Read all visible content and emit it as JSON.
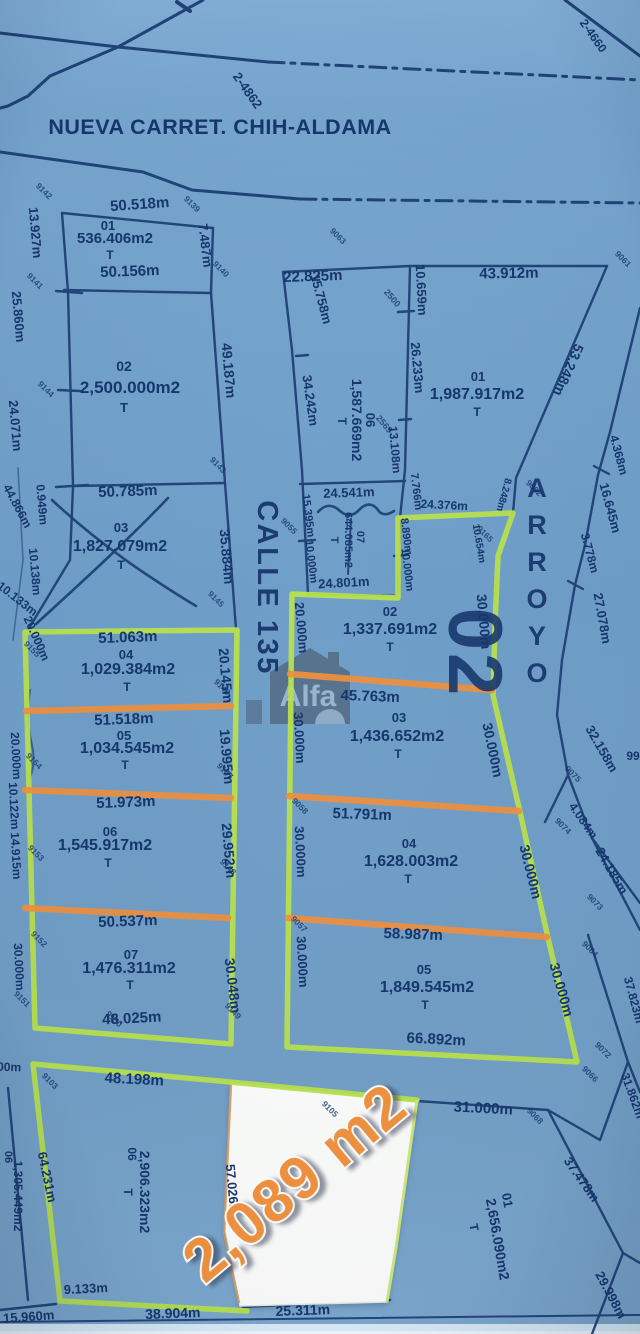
{
  "page": {
    "road_title": "NUEVA CARRET. CHIH-ALDAMA",
    "street_label": "CALLE 135",
    "block_number": "02",
    "watermark": "Alfa",
    "highlight_area": "2,089 m2"
  },
  "colors": {
    "paper_blue": "#74a3cc",
    "line_navy": "#1c3e74",
    "text_navy": "#17366d",
    "boundary_green": "#b9e14e",
    "divider_orange": "#ef9040",
    "highlight_orange": "#f2923e",
    "parcel_white": "#fcfdfb"
  },
  "labels": [
    {
      "t": "2-4862",
      "x": 244,
      "y": 93,
      "r": 55,
      "s": 13
    },
    {
      "t": "2-4660",
      "x": 590,
      "y": 38,
      "r": 55,
      "s": 12
    },
    {
      "t": "50.518m",
      "x": 140,
      "y": 209,
      "r": -4,
      "s": 15
    },
    {
      "t": "01",
      "x": 108,
      "y": 230,
      "s": 13,
      "k": "id"
    },
    {
      "t": "536.406m2",
      "x": 115,
      "y": 243,
      "s": 15,
      "k": "a"
    },
    {
      "t": "T",
      "x": 110,
      "y": 259,
      "s": 12,
      "k": "tee"
    },
    {
      "t": "50.156m",
      "x": 130,
      "y": 276,
      "r": -2,
      "s": 15
    },
    {
      "t": "7.487m",
      "x": 201,
      "y": 246,
      "r": 83,
      "s": 13
    },
    {
      "t": "13.927m",
      "x": 31,
      "y": 233,
      "r": 85,
      "s": 13
    },
    {
      "t": "02",
      "x": 124,
      "y": 371,
      "s": 14,
      "k": "id"
    },
    {
      "t": "2,500.000m2",
      "x": 130,
      "y": 393,
      "s": 17,
      "k": "a"
    },
    {
      "t": "T",
      "x": 124,
      "y": 412,
      "s": 13,
      "k": "tee"
    },
    {
      "t": "49.187m",
      "x": 224,
      "y": 371,
      "r": 85,
      "s": 14
    },
    {
      "t": "25.860m",
      "x": 14,
      "y": 317,
      "r": 85,
      "s": 13
    },
    {
      "t": "24.071m",
      "x": 11,
      "y": 426,
      "r": 85,
      "s": 13
    },
    {
      "t": "50.785m",
      "x": 128,
      "y": 496,
      "r": -2,
      "s": 15
    },
    {
      "t": "03",
      "x": 121,
      "y": 532,
      "s": 13,
      "k": "id"
    },
    {
      "t": "1,827.079m2",
      "x": 120,
      "y": 551,
      "s": 16,
      "k": "a"
    },
    {
      "t": "T",
      "x": 121,
      "y": 569,
      "s": 12,
      "k": "tee"
    },
    {
      "t": "35.884m",
      "x": 222,
      "y": 557,
      "r": 85,
      "s": 14
    },
    {
      "t": "0.949m",
      "x": 38,
      "y": 505,
      "r": 85,
      "s": 12
    },
    {
      "t": "44.866m",
      "x": 14,
      "y": 508,
      "r": 62,
      "s": 12
    },
    {
      "t": "10.138m",
      "x": 31,
      "y": 572,
      "r": 85,
      "s": 12
    },
    {
      "t": "10.133m",
      "x": 15,
      "y": 602,
      "r": 38,
      "s": 12
    },
    {
      "t": "20.000m",
      "x": 33,
      "y": 640,
      "r": 66,
      "s": 12
    },
    {
      "t": "51.063m",
      "x": 128,
      "y": 642,
      "r": -2,
      "s": 15
    },
    {
      "t": "04",
      "x": 126,
      "y": 659,
      "s": 13,
      "k": "id"
    },
    {
      "t": "1,029.384m2",
      "x": 128,
      "y": 674,
      "s": 16,
      "k": "a"
    },
    {
      "t": "T",
      "x": 127,
      "y": 691,
      "s": 12,
      "k": "tee"
    },
    {
      "t": "20.145m",
      "x": 221,
      "y": 676,
      "r": 85,
      "s": 14
    },
    {
      "t": "51.518m",
      "x": 124,
      "y": 724,
      "r": -2,
      "s": 15
    },
    {
      "t": "05",
      "x": 124,
      "y": 740,
      "s": 13,
      "k": "id"
    },
    {
      "t": "1,034.545m2",
      "x": 127,
      "y": 753,
      "s": 16,
      "k": "a"
    },
    {
      "t": "T",
      "x": 125,
      "y": 769,
      "s": 12,
      "k": "tee"
    },
    {
      "t": "19.995m",
      "x": 222,
      "y": 757,
      "r": 85,
      "s": 14
    },
    {
      "t": "20.000m",
      "x": 12,
      "y": 756,
      "r": 87,
      "s": 12
    },
    {
      "t": "51.973m",
      "x": 126,
      "y": 807,
      "r": -2,
      "s": 15
    },
    {
      "t": "06",
      "x": 110,
      "y": 836,
      "s": 13,
      "k": "id"
    },
    {
      "t": "1,545.917m2",
      "x": 105,
      "y": 850,
      "s": 16,
      "k": "a"
    },
    {
      "t": "T",
      "x": 108,
      "y": 867,
      "s": 12,
      "k": "tee"
    },
    {
      "t": "29.952m",
      "x": 224,
      "y": 851,
      "r": 85,
      "s": 14
    },
    {
      "t": "10.122m",
      "x": 10,
      "y": 806,
      "r": 87,
      "s": 12
    },
    {
      "t": "14.915m",
      "x": 12,
      "y": 856,
      "r": 87,
      "s": 12
    },
    {
      "t": "50.537m",
      "x": 128,
      "y": 926,
      "r": -2,
      "s": 15
    },
    {
      "t": "07",
      "x": 131,
      "y": 959,
      "s": 13,
      "k": "id"
    },
    {
      "t": "1,476.311m2",
      "x": 129,
      "y": 973,
      "s": 16,
      "k": "a"
    },
    {
      "t": "T",
      "x": 130,
      "y": 989,
      "s": 12,
      "k": "tee"
    },
    {
      "t": "30.048m",
      "x": 228,
      "y": 986,
      "r": 83,
      "s": 14
    },
    {
      "t": "30.000m",
      "x": 15,
      "y": 967,
      "r": 87,
      "s": 12
    },
    {
      "t": "48.025m",
      "x": 132,
      "y": 1023,
      "r": -3,
      "s": 15
    },
    {
      "t": "22.825m",
      "x": 313,
      "y": 281,
      "r": -2,
      "s": 15
    },
    {
      "t": "10.659m",
      "x": 417,
      "y": 290,
      "r": 87,
      "s": 13
    },
    {
      "t": "43.912m",
      "x": 509,
      "y": 278,
      "r": -1,
      "s": 15
    },
    {
      "t": "15.758m",
      "x": 317,
      "y": 300,
      "r": 75,
      "s": 13
    },
    {
      "t": "34.242m",
      "x": 306,
      "y": 401,
      "r": 82,
      "s": 13
    },
    {
      "t": "26.233m",
      "x": 413,
      "y": 368,
      "r": 85,
      "s": 13
    },
    {
      "t": "13.108m",
      "x": 391,
      "y": 450,
      "r": 85,
      "s": 12
    },
    {
      "t": "06",
      "x": 366,
      "y": 420,
      "r": 90,
      "s": 13,
      "k": "id"
    },
    {
      "t": "1,587.669m2",
      "x": 352,
      "y": 420,
      "r": 90,
      "s": 14,
      "k": "a"
    },
    {
      "t": "T",
      "x": 338,
      "y": 421,
      "r": 90,
      "s": 12,
      "k": "tee"
    },
    {
      "t": "01",
      "x": 478,
      "y": 381,
      "s": 13,
      "k": "id"
    },
    {
      "t": "1,987.917m2",
      "x": 477,
      "y": 399,
      "s": 16,
      "k": "a"
    },
    {
      "t": "T",
      "x": 477,
      "y": 416,
      "s": 12,
      "k": "tee"
    },
    {
      "t": "53.248m",
      "x": 564,
      "y": 368,
      "r": 114,
      "s": 14
    },
    {
      "t": "8.248m",
      "x": 501,
      "y": 494,
      "r": 105,
      "s": 10
    },
    {
      "t": "24.541m",
      "x": 349,
      "y": 497,
      "r": -2,
      "s": 13
    },
    {
      "t": "07",
      "x": 357,
      "y": 537,
      "r": 90,
      "s": 11,
      "k": "id"
    },
    {
      "t": "644.085m2",
      "x": 345,
      "y": 540,
      "r": 90,
      "s": 11,
      "k": "a"
    },
    {
      "t": "T",
      "x": 331,
      "y": 540,
      "r": 90,
      "s": 11,
      "k": "tee"
    },
    {
      "t": "24.801m",
      "x": 344,
      "y": 587,
      "r": -3,
      "s": 13
    },
    {
      "t": "15.395m",
      "x": 305,
      "y": 516,
      "r": 83,
      "s": 11
    },
    {
      "t": "10.000m",
      "x": 308,
      "y": 562,
      "r": 83,
      "s": 11
    },
    {
      "t": "7.766m",
      "x": 413,
      "y": 492,
      "r": 83,
      "s": 11
    },
    {
      "t": "8.890m",
      "x": 403,
      "y": 537,
      "r": 83,
      "s": 11
    },
    {
      "t": "10.000m",
      "x": 404,
      "y": 570,
      "r": 83,
      "s": 11
    },
    {
      "t": "24.376m",
      "x": 444,
      "y": 509,
      "r": 3,
      "s": 12
    },
    {
      "t": "10.654m",
      "x": 476,
      "y": 544,
      "r": 80,
      "s": 10
    },
    {
      "t": "02",
      "x": 390,
      "y": 616,
      "s": 13,
      "k": "id"
    },
    {
      "t": "1,337.691m2",
      "x": 390,
      "y": 634,
      "s": 16,
      "k": "a"
    },
    {
      "t": "T",
      "x": 390,
      "y": 651,
      "s": 12,
      "k": "tee"
    },
    {
      "t": "20.000m",
      "x": 297,
      "y": 628,
      "r": 85,
      "s": 13
    },
    {
      "t": "30.000m",
      "x": 479,
      "y": 622,
      "r": 85,
      "s": 14
    },
    {
      "t": "45.763m",
      "x": 370,
      "y": 701,
      "r": 2,
      "s": 15
    },
    {
      "t": "03",
      "x": 399,
      "y": 722,
      "s": 13,
      "k": "id"
    },
    {
      "t": "1,436.652m2",
      "x": 397,
      "y": 741,
      "s": 16,
      "k": "a"
    },
    {
      "t": "T",
      "x": 398,
      "y": 758,
      "s": 12,
      "k": "tee"
    },
    {
      "t": "30.000m",
      "x": 295,
      "y": 738,
      "r": 87,
      "s": 13
    },
    {
      "t": "30.000m",
      "x": 488,
      "y": 751,
      "r": 78,
      "s": 14
    },
    {
      "t": "51.791m",
      "x": 362,
      "y": 819,
      "r": 2,
      "s": 15
    },
    {
      "t": "04",
      "x": 409,
      "y": 848,
      "s": 13,
      "k": "id"
    },
    {
      "t": "1,628.003m2",
      "x": 411,
      "y": 866,
      "s": 16,
      "k": "a"
    },
    {
      "t": "T",
      "x": 408,
      "y": 883,
      "s": 12,
      "k": "tee"
    },
    {
      "t": "30.000m",
      "x": 296,
      "y": 852,
      "r": 87,
      "s": 13
    },
    {
      "t": "30.000m",
      "x": 526,
      "y": 873,
      "r": 76,
      "s": 14
    },
    {
      "t": "58.987m",
      "x": 413,
      "y": 939,
      "r": 2,
      "s": 15
    },
    {
      "t": "05",
      "x": 424,
      "y": 974,
      "s": 13,
      "k": "id"
    },
    {
      "t": "1,849.545m2",
      "x": 427,
      "y": 992,
      "s": 16,
      "k": "a"
    },
    {
      "t": "T",
      "x": 425,
      "y": 1009,
      "s": 12,
      "k": "tee"
    },
    {
      "t": "30.000m",
      "x": 298,
      "y": 962,
      "r": 87,
      "s": 13
    },
    {
      "t": "30.000m",
      "x": 557,
      "y": 991,
      "r": 74,
      "s": 14
    },
    {
      "t": "66.892m",
      "x": 436,
      "y": 1044,
      "r": 3,
      "s": 15
    },
    {
      "t": "ARROYO",
      "x": 537,
      "y": 497,
      "s": 27,
      "k": "vs",
      "dy": 37
    },
    {
      "t": "4.368m",
      "x": 615,
      "y": 456,
      "r": 75,
      "s": 12
    },
    {
      "t": "16.645m",
      "x": 606,
      "y": 509,
      "r": 75,
      "s": 13
    },
    {
      "t": "3.778m",
      "x": 586,
      "y": 554,
      "r": 75,
      "s": 12
    },
    {
      "t": "27.078m",
      "x": 598,
      "y": 619,
      "r": 80,
      "s": 13
    },
    {
      "t": "32.158m",
      "x": 598,
      "y": 751,
      "r": 60,
      "s": 13
    },
    {
      "t": "99",
      "x": 633,
      "y": 760,
      "r": 0,
      "s": 12
    },
    {
      "t": "4.084m",
      "x": 580,
      "y": 823,
      "r": 55,
      "s": 12
    },
    {
      "t": "24.185m",
      "x": 608,
      "y": 873,
      "r": 60,
      "s": 13
    },
    {
      "t": "37.823m",
      "x": 630,
      "y": 1001,
      "r": 75,
      "s": 12
    },
    {
      "t": "31.862m",
      "x": 629,
      "y": 1097,
      "r": 70,
      "s": 12
    },
    {
      "t": "48.198m",
      "x": 134,
      "y": 1084,
      "r": 3,
      "s": 15
    },
    {
      "t": "06",
      "x": 128,
      "y": 1154,
      "r": 90,
      "s": 12,
      "k": "id"
    },
    {
      "t": "2,906.323m2",
      "x": 140,
      "y": 1192,
      "r": 90,
      "s": 14,
      "k": "a"
    },
    {
      "t": "T",
      "x": 124,
      "y": 1192,
      "r": 90,
      "s": 12,
      "k": "tee"
    },
    {
      "t": "64.231m",
      "x": 43,
      "y": 1178,
      "r": 78,
      "s": 13
    },
    {
      "t": "57.026m",
      "x": 228,
      "y": 1190,
      "r": 85,
      "s": 13
    },
    {
      "t": "06",
      "x": 5,
      "y": 1157,
      "r": 90,
      "s": 11,
      "k": "id"
    },
    {
      "t": "1,305.449m2",
      "x": 14,
      "y": 1196,
      "r": 90,
      "s": 12,
      "k": "a"
    },
    {
      "t": "9.133m",
      "x": 86,
      "y": 1293,
      "r": -3,
      "s": 13
    },
    {
      "t": "15.960m",
      "x": 29,
      "y": 1321,
      "r": -4,
      "s": 13
    },
    {
      "t": "38.904m",
      "x": 173,
      "y": 1318,
      "r": -2,
      "s": 14
    },
    {
      "t": "25.311m",
      "x": 303,
      "y": 1315,
      "r": -2,
      "s": 14
    },
    {
      "t": "00m",
      "x": 9,
      "y": 1071,
      "r": 2,
      "s": 12
    },
    {
      "t": "31.000m",
      "x": 483,
      "y": 1113,
      "r": 3,
      "s": 15
    },
    {
      "t": "37.478m",
      "x": 578,
      "y": 1182,
      "r": 55,
      "s": 13
    },
    {
      "t": "01",
      "x": 503,
      "y": 1201,
      "r": 80,
      "s": 13,
      "k": "id"
    },
    {
      "t": "2,656.090m2",
      "x": 493,
      "y": 1240,
      "r": 80,
      "s": 14,
      "k": "a"
    },
    {
      "t": "T",
      "x": 470,
      "y": 1228,
      "r": 80,
      "s": 12,
      "k": "tee"
    },
    {
      "t": "29.998m",
      "x": 607,
      "y": 1297,
      "r": 62,
      "s": 13
    },
    {
      "t": "9142",
      "x": 42,
      "y": 193,
      "k": "pt"
    },
    {
      "t": "9139",
      "x": 190,
      "y": 206,
      "k": "pt"
    },
    {
      "t": "9141",
      "x": 33,
      "y": 283,
      "k": "pt"
    },
    {
      "t": "9140",
      "x": 219,
      "y": 271,
      "k": "pt"
    },
    {
      "t": "9144",
      "x": 44,
      "y": 391,
      "k": "pt"
    },
    {
      "t": "9143",
      "x": 216,
      "y": 467,
      "k": "pt"
    },
    {
      "t": "9063",
      "x": 336,
      "y": 238,
      "k": "pt"
    },
    {
      "t": "9061",
      "x": 621,
      "y": 261,
      "k": "pt"
    },
    {
      "t": "9062",
      "x": 532,
      "y": 490,
      "k": "pt"
    },
    {
      "t": "9055",
      "x": 287,
      "y": 528,
      "k": "pt"
    },
    {
      "t": "9165",
      "x": 483,
      "y": 536,
      "k": "pt"
    },
    {
      "t": "9145",
      "x": 214,
      "y": 601,
      "k": "pt"
    },
    {
      "t": "9146",
      "x": 220,
      "y": 689,
      "k": "pt"
    },
    {
      "t": "9147",
      "x": 223,
      "y": 773,
      "k": "pt"
    },
    {
      "t": "9148",
      "x": 226,
      "y": 869,
      "k": "pt"
    },
    {
      "t": "9149",
      "x": 231,
      "y": 1013,
      "k": "pt"
    },
    {
      "t": "9151",
      "x": 20,
      "y": 1001,
      "k": "pt"
    },
    {
      "t": "9150",
      "x": 112,
      "y": 1021,
      "k": "pt"
    },
    {
      "t": "9155",
      "x": 30,
      "y": 651,
      "k": "pt"
    },
    {
      "t": "9154",
      "x": 32,
      "y": 763,
      "k": "pt"
    },
    {
      "t": "9153",
      "x": 34,
      "y": 855,
      "k": "pt"
    },
    {
      "t": "9152",
      "x": 37,
      "y": 941,
      "k": "pt"
    },
    {
      "t": "9058",
      "x": 298,
      "y": 808,
      "k": "pt"
    },
    {
      "t": "9057",
      "x": 297,
      "y": 926,
      "k": "pt"
    },
    {
      "t": "9075",
      "x": 571,
      "y": 776,
      "k": "pt"
    },
    {
      "t": "9074",
      "x": 561,
      "y": 828,
      "k": "pt"
    },
    {
      "t": "9073",
      "x": 593,
      "y": 904,
      "k": "pt"
    },
    {
      "t": "9064",
      "x": 588,
      "y": 951,
      "k": "pt"
    },
    {
      "t": "9072",
      "x": 601,
      "y": 1052,
      "k": "pt"
    },
    {
      "t": "9066",
      "x": 588,
      "y": 1076,
      "k": "pt"
    },
    {
      "t": "9068",
      "x": 533,
      "y": 1118,
      "k": "pt"
    },
    {
      "t": "9103",
      "x": 48,
      "y": 1083,
      "k": "pt"
    },
    {
      "t": "9105",
      "x": 328,
      "y": 1111,
      "k": "pt"
    },
    {
      "t": "2500",
      "x": 390,
      "y": 300,
      "r": 50,
      "s": 9,
      "k": "pt"
    },
    {
      "t": "2569",
      "x": 382,
      "y": 426,
      "r": 50,
      "s": 9,
      "k": "pt"
    }
  ]
}
